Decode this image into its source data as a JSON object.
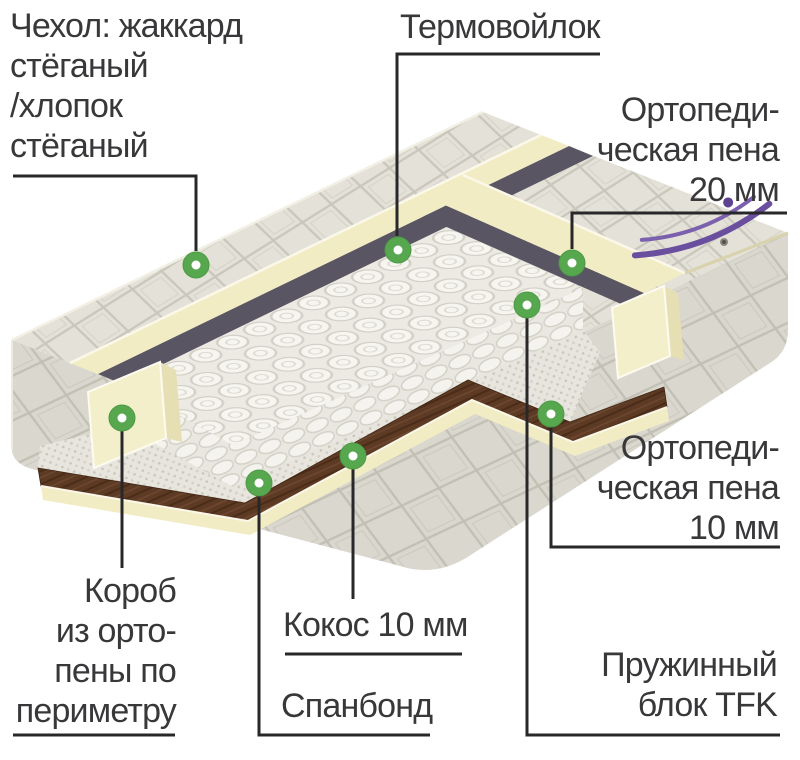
{
  "diagram": {
    "type": "mattress-layers-infographic",
    "callouts": {
      "cover": {
        "label": "Чехол: жаккард\nстёганый\n/хлопок\nстёганый"
      },
      "thermofelt": {
        "label": "Термовойлок"
      },
      "foam20": {
        "label": "Ортопеди-\nческая пена\n20 мм"
      },
      "foam10": {
        "label": "Ортопеди-\nческая пена\n10 мм"
      },
      "perimeter_box": {
        "label": "Короб\nиз орто-\nпены по\nпериметру"
      },
      "coconut": {
        "label": "Кокос 10 мм"
      },
      "spunbond": {
        "label": "Спанбонд"
      },
      "spring_block": {
        "label": "Пружинный\nблок TFK"
      }
    },
    "colors": {
      "marker_green": "#56a74d",
      "marker_center": "#ffffff",
      "leader_line": "#28282a",
      "label_text": "#38383a",
      "foam_cream": "#f1ecc4",
      "felt_dark": "#5a5562",
      "coconut_brown": "#5d3a24",
      "spring_white": "#f6f5f0",
      "cover_gray": "#e3e1d8",
      "logo_purple": "#6a4f9e"
    }
  }
}
